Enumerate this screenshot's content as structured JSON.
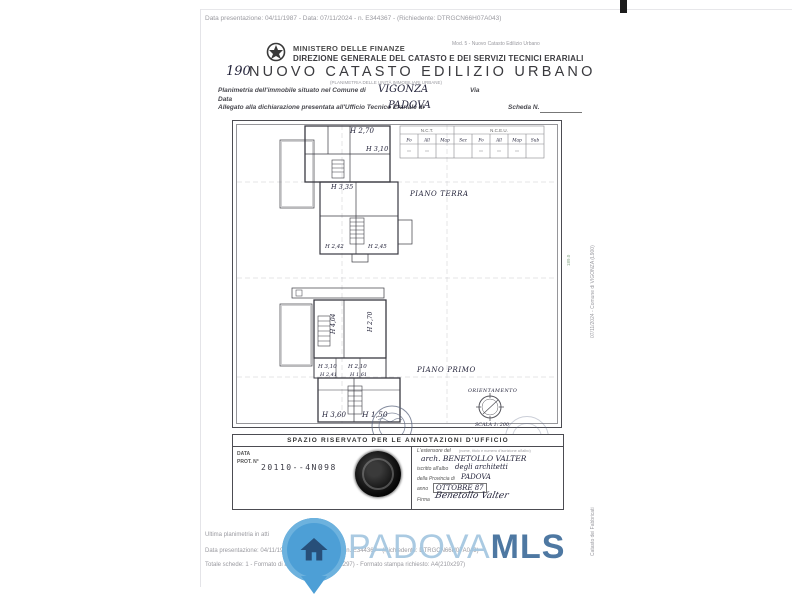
{
  "scan": {
    "top_meta": "Data presentazione: 04/11/1987 - Data: 07/11/2024 - n. E344367 - (Richiedente: DTRGCN66H07A043)",
    "side_upper": "07/11/2024 - Comune di VIGONZA (L900)",
    "side_lower": "Catasto dei Fabbricati",
    "side_mark": "189.0"
  },
  "header": {
    "mod_ref": "Mod. 5 - Nuovo Catasto Edilizio Urbano",
    "ministry": "MINISTERO DELLE FINANZE",
    "direction": "DIREZIONE GENERALE DEL CATASTO E DEI SERVIZI TECNICI ERARIALI",
    "sheet_no": "190",
    "title": "NUOVO CATASTO EDILIZIO URBANO",
    "subtitle": "(PLANIMETRIA DELLE UNITÀ IMMOBILIARI URBANE)"
  },
  "form": {
    "comune_label": "Planimetria dell'immobile situato nel Comune di",
    "comune_value": "VIGONZA",
    "via_label": "Via",
    "data_label": "Data",
    "ufficio_label": "Allegato alla dichiarazione presentata all'Ufficio Tecnico Erariale di",
    "ufficio_value": "PADOVA",
    "scheda_label": "Scheda N."
  },
  "plan": {
    "ref_table": {
      "groups": [
        {
          "name": "N.C.T.",
          "cols": [
            "Fo",
            "All",
            "Map"
          ]
        },
        {
          "name": "N.C.E.U.",
          "cols": [
            "Sez",
            "Fo",
            "All",
            "Map",
            "Sub"
          ]
        }
      ]
    },
    "pt": {
      "h1": "H 2,70",
      "h2": "H 3,10",
      "h3": "H 3,35",
      "h4": "H 2,42",
      "h5": "H 2,45",
      "floor": "PIANO TERRA"
    },
    "pp": {
      "h1": "H 4,04",
      "h2": "H 2,70",
      "h3": "H 3,10",
      "h4": "H 2,10",
      "h5": "H 2,41",
      "h6": "H 1,61",
      "h7": "H 3,60",
      "h8": "H 1,50",
      "floor": "PIANO PRIMO"
    },
    "orientation": "ORIENTAMENTO",
    "scale": "SCALA 1: 200"
  },
  "office": {
    "title": "SPAZIO RISERVATO PER LE ANNOTAZIONI D'UFFICIO",
    "data_label": "DATA",
    "prot_label": "PROT. N°",
    "stamp_no": "20110--4N098",
    "estensore_label": "L'estensore del",
    "estensore_note": "(nome, titolo e numero d'iscrizione all'albo)",
    "name_value": "arch. BENETOLLO VALTER",
    "albo_label": "iscritto all'albo",
    "albo_value": "degli architetti",
    "prov_label": "della Provincia di",
    "prov_value": "PADOVA",
    "anno_label": "anno",
    "anno_value": "OTTOBRE 87",
    "firma_label": "Firma",
    "firma_value": "Benetollo Valter"
  },
  "footer": {
    "line1": "Ultima planimetria in atti",
    "line2": "Data presentazione: 04/11/1987 - Data: 07/11/2024 - n. E344367 - (Richiedente: DTRGCN66H07A043)",
    "line3": "Totale schede: 1 - Formato di acquisizione: A4(210x297) - Formato stampa richiesto: A4(210x297)"
  },
  "watermark": {
    "brand_light": "PADOVA",
    "brand_bold": "MLS",
    "pin_color": "#4d9fd6",
    "light_color": "#a3c6e0",
    "bold_color": "#3f6d9b"
  }
}
